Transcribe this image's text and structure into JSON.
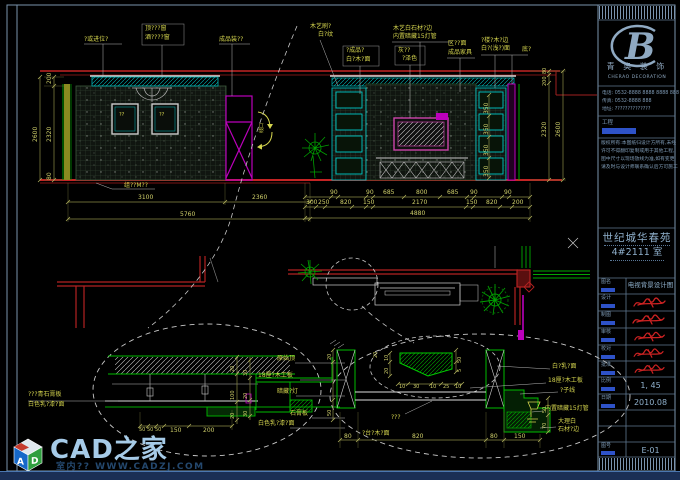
{
  "logo_badge": {
    "text": "CAD之家",
    "sub": "室内?? WWW.CADZJ.COM",
    "cube_a": "A",
    "cube_d": "D"
  },
  "title_block": {
    "brand_letter": "B",
    "brand_cn": "青 奥 装 饰",
    "brand_en": "CHERAO DECORATION",
    "contact": [
      "电话: 0532-8888 8888  8888 888",
      "传真: 0532-8888 888",
      "地址: ??????????????"
    ],
    "project_label": "工程",
    "notes": [
      "版权所有:本图纸归设计方所有,未经",
      "许可不得翻印复制或用于其他工程,",
      "图中尺寸以现场放线为准,如有变更",
      "请及时与设计师联系确认后方可施工"
    ],
    "project_name_1": "世纪城华春苑",
    "project_name_2": "4#2111 室",
    "rows": [
      {
        "label": "图名",
        "value": "电视背景设计图"
      },
      {
        "label": "设计",
        "value": ""
      },
      {
        "label": "制图",
        "value": ""
      },
      {
        "label": "审核",
        "value": ""
      },
      {
        "label": "校对",
        "value": ""
      },
      {
        "label": "批准",
        "value": ""
      },
      {
        "label": "比例",
        "value": "1, 45"
      },
      {
        "label": "日期",
        "value": "2010.08"
      },
      {
        "label": "",
        "value": ""
      },
      {
        "label": "",
        "value": ""
      },
      {
        "label": "图号",
        "value": "E-01"
      }
    ]
  },
  "left_elev": {
    "label_wall": "?或进位?",
    "label_box1": "顶???窗",
    "label_box2": "酒????窗",
    "label_right": "成品装??",
    "frame_mark": "??",
    "label_floor": "组??M??",
    "dim_3100": "3100",
    "dim_2360": "2360",
    "dim_5760": "5760",
    "v_200": "200",
    "v_2320": "2320",
    "v_80": "80",
    "v_2600": "2600"
  },
  "right_elev": {
    "lbl1a": "木艺刷?",
    "lbl1b": "白?纹",
    "lbl2a": "?成品?",
    "lbl2b": "白?木?面",
    "lbl3a": "木艺白石材?边",
    "lbl3b": "内置暗藏15灯管",
    "lbl4a": "灰??",
    "lbl4b": "?泽色",
    "lbl5a": "区??面",
    "lbl5b": "成品家具",
    "lbl6a": "?楼?木?边",
    "lbl6b": "白?(浅?)面",
    "lbl7": "底?",
    "swing_mark": "线口",
    "row1": [
      "90",
      "90",
      "685",
      "800",
      "685",
      "90",
      "90"
    ],
    "row2": [
      "300",
      "250",
      "820",
      "150",
      "2170",
      "150",
      "820",
      "200"
    ],
    "dim_total": "4880",
    "vchain": [
      "350",
      "350",
      "350",
      "350"
    ],
    "v_80": "80",
    "v_200": "200",
    "v_2320": "2320",
    "v_2600": "2600"
  },
  "detail1": {
    "lbl_left1": "???青石膏板",
    "lbl_left2": "白色乳?漆?面",
    "lbl_r1": "原始顶",
    "lbl_r2": "18厘?木工板",
    "lbl_r3": "暗藏?灯",
    "lbl_r4": "石膏板",
    "lbl_r5": "白色乳?漆?面",
    "dims_bottom": [
      "50",
      "50",
      "50",
      "150",
      "200"
    ],
    "vdims1": [
      "20",
      "100",
      "20"
    ],
    "vdims2": [
      "30",
      "20",
      "30"
    ]
  },
  "detail2": {
    "lbl_q": "???",
    "lbl_base": "?台?木?面",
    "lbl_r1": "白?乳?面",
    "lbl_r2": "18厘?木工板",
    "lbl_r3": "?子线",
    "lbl_r4": "内置暗藏15灯管",
    "lbl_r5": "大理白",
    "lbl_r6": "石材?边",
    "profile_h": [
      "10",
      "30",
      "10",
      "25",
      "10"
    ],
    "profile_left": [
      "20",
      "10",
      "20"
    ],
    "profile_right": [
      "50",
      "5"
    ],
    "post_left": [
      "20",
      "50"
    ],
    "post_right": [
      "50",
      "70"
    ],
    "dims_bottom": [
      "80",
      "820",
      "80",
      "150"
    ]
  }
}
